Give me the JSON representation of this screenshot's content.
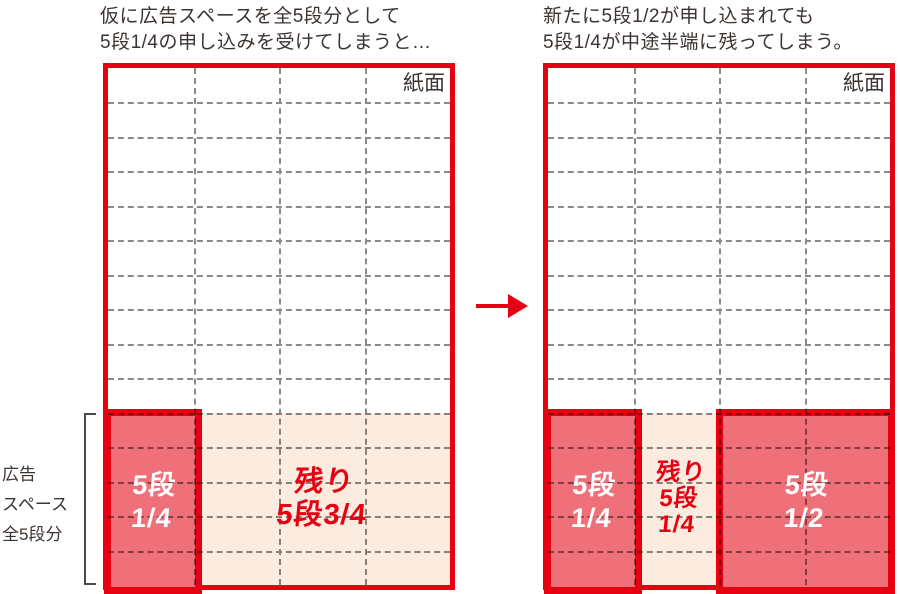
{
  "left_panel": {
    "title_line1": "仮に広告スペースを全5段分として",
    "title_line2": "5段1/4の申し込みを受けてしまうと…",
    "paper_label": "紙面",
    "block_quarter": {
      "line1": "5段",
      "line2": "1/4"
    },
    "remainder": {
      "line1": "残り",
      "line2": "5段3/4"
    }
  },
  "right_panel": {
    "title_line1": "新たに5段1/2が申し込まれても",
    "title_line2": "5段1/4が中途半端に残ってしまう。",
    "paper_label": "紙面",
    "block_quarter": {
      "line1": "5段",
      "line2": "1/4"
    },
    "remainder": {
      "line1": "残り",
      "line2": "5段",
      "line3": "1/4"
    },
    "block_half": {
      "line1": "5段",
      "line2": "1/2"
    }
  },
  "side_label": {
    "line1": "広告",
    "line2": "スペース",
    "line3": "全5段分"
  },
  "arrow_icon": "right-arrow",
  "grid": {
    "rows": 15,
    "cols": 4
  },
  "colors": {
    "red": "#e60012",
    "blockfill": "#f0707a",
    "pink": "#fcebdf",
    "ink": "#3b3431",
    "grid": "#8a8a8a",
    "bracket": "#4d4845"
  }
}
